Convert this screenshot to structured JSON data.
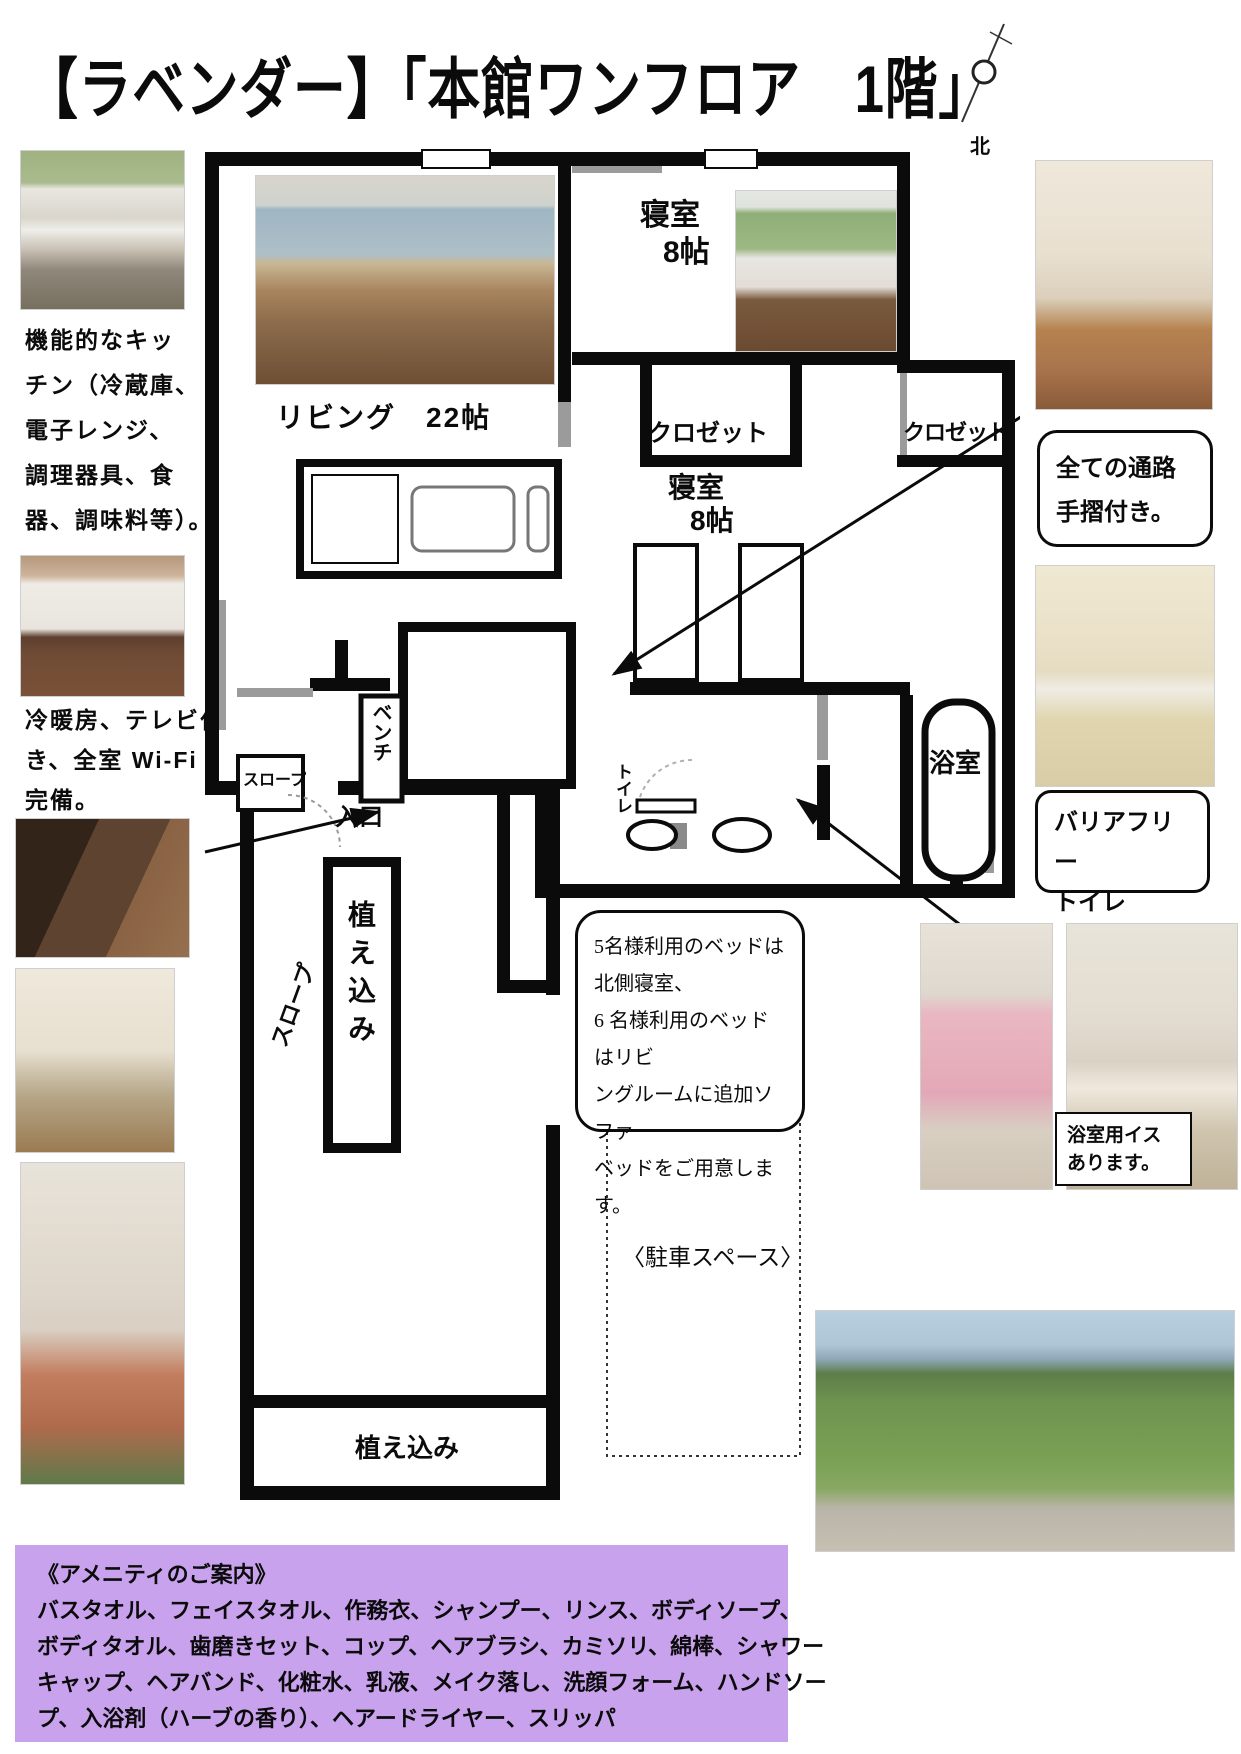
{
  "title": "【ラベンダー】「本館ワンフロア　1階」",
  "compass": {
    "north_label": "北"
  },
  "left_column": {
    "kitchen_note": [
      "機能的なキッ",
      "チン（冷蔵庫、",
      "電子レンジ、",
      "調理器具、食",
      "器、調味料等）。"
    ],
    "room_note": [
      "冷暖房、テレビ付",
      "き、全室 Wi-Fi",
      "完備。"
    ]
  },
  "floor_plan": {
    "bedroom_north": {
      "name": "寝室",
      "size": "8帖"
    },
    "bedroom_south": {
      "name": "寝室",
      "size": "8帖"
    },
    "living": "リビング　22帖",
    "closet_left": "クロゼット",
    "closet_right": "クロゼット",
    "bench": "ベンチ",
    "slope_box": "スロープ",
    "toilet": "トイレ",
    "bath": "浴室",
    "entrance": "入口",
    "planting_tall": "植え込み",
    "slope_path": "スロープ",
    "planting_bottom": "植え込み",
    "parking": "〈駐車スペース〉"
  },
  "callouts": {
    "handrail": [
      "全ての通路",
      "手摺付き。"
    ],
    "barrier_free": [
      "バリアフリー",
      "トイレ"
    ],
    "bath_chair": [
      "浴室用イス",
      "あります。"
    ],
    "bed_info": [
      "5名様利用のベッドは",
      "北側寝室、",
      "6 名様利用のベッドはリビ",
      "ングルームに追加ソファー",
      "ベッドをご用意します。"
    ]
  },
  "amenities": {
    "heading": "《アメニティのご案内》",
    "lines": [
      "バスタオル、フェイスタオル、作務衣、シャンプー、リンス、ボディソープ、",
      "ボディタオル、歯磨きセット、コップ、ヘアブラシ、カミソリ、綿棒、シャワー",
      "キャップ、ヘアバンド、化粧水、乳液、メイク落し、洗顔フォーム、ハンドソー",
      "プ、入浴剤（ハーブの香り）、ヘアードライヤー、スリッパ"
    ],
    "bg_color": "#c9a2ee"
  }
}
